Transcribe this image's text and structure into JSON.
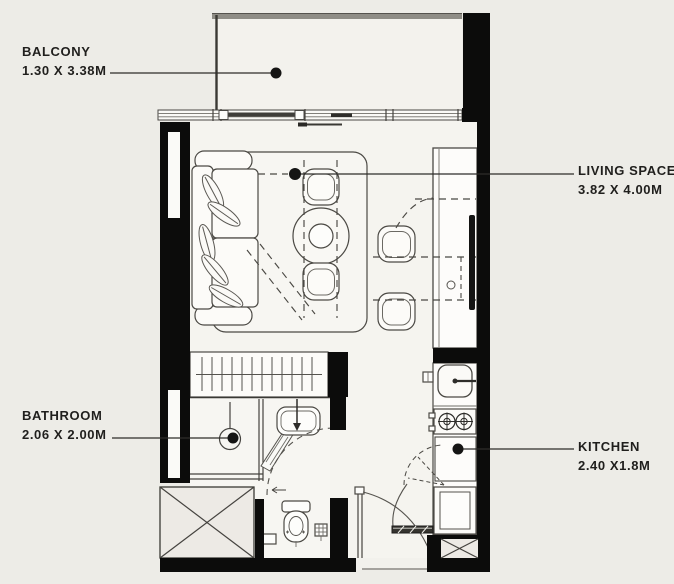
{
  "rooms": {
    "balcony": {
      "name": "BALCONY",
      "dimensions": "1.30 X 3.38M"
    },
    "living_space": {
      "name": "LIVING SPACE",
      "dimensions": "3.82 X 4.00M"
    },
    "bathroom": {
      "name": "BATHROOM",
      "dimensions": "2.06 X 2.00M"
    },
    "kitchen": {
      "name": "KITCHEN",
      "dimensions": "2.40 X1.8M"
    }
  },
  "colors": {
    "background": "#edece7",
    "interior_floor": "#f5f4ef",
    "wall": "#0c0c0b",
    "line": "#45433f",
    "label_text": "#201f1d"
  }
}
